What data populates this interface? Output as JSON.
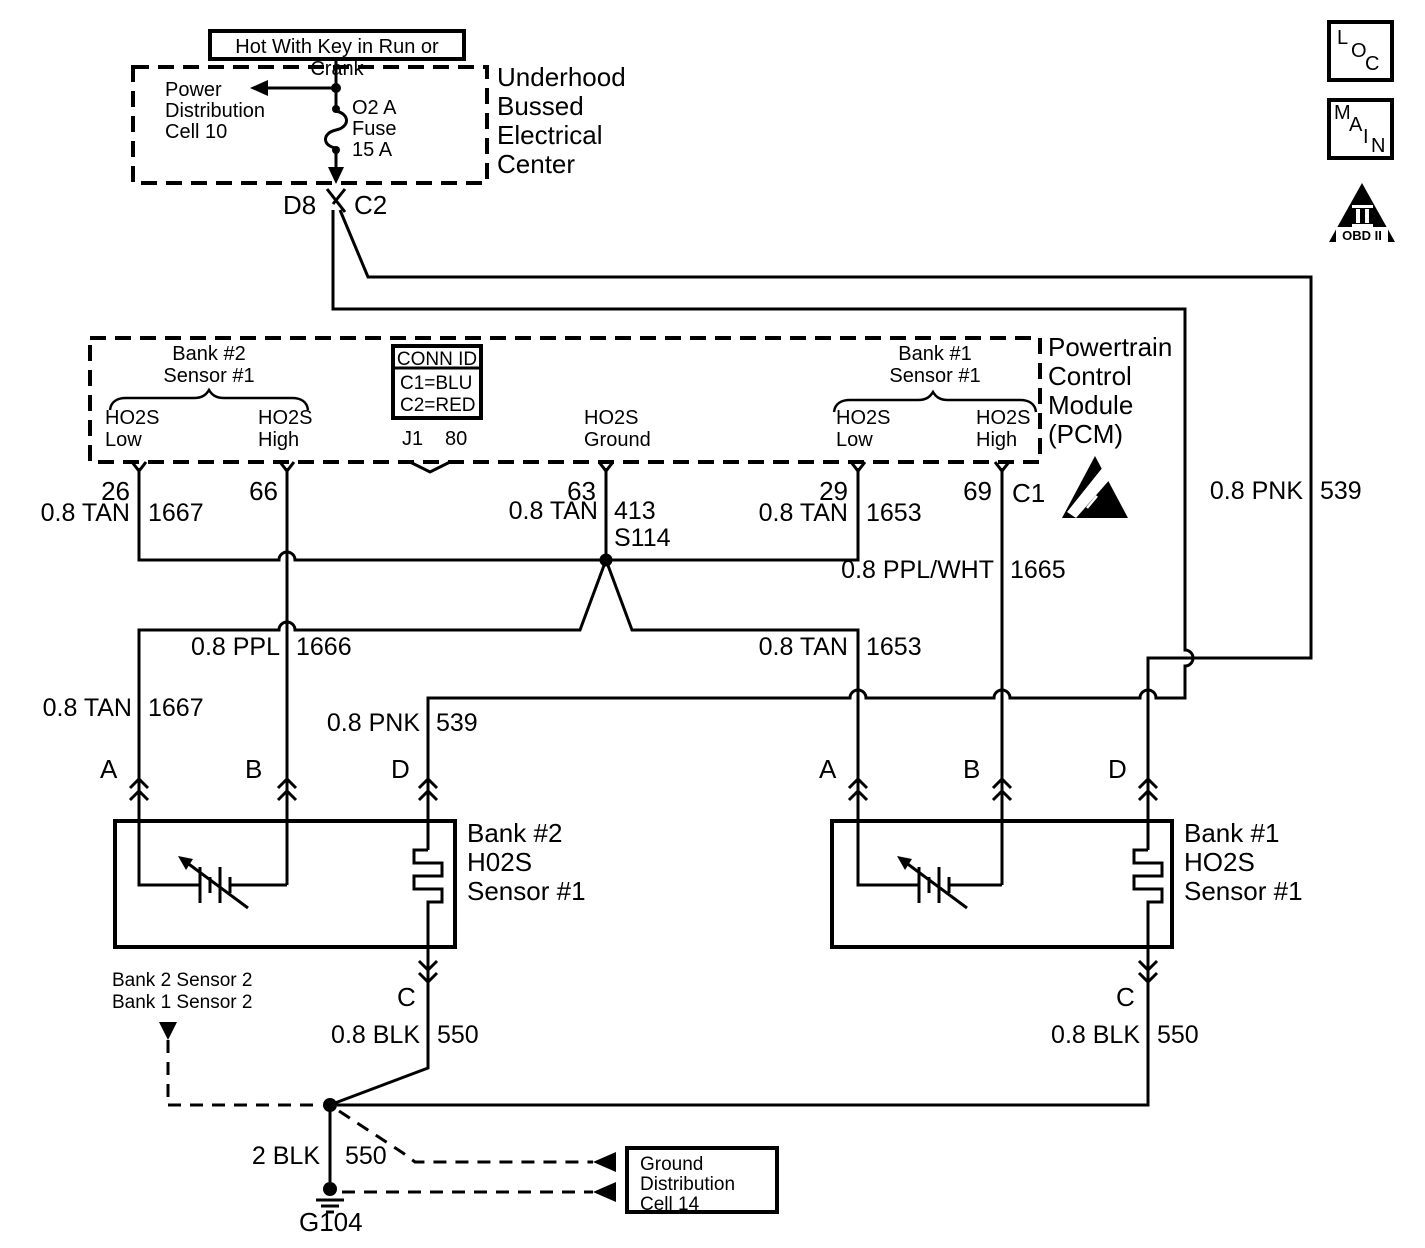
{
  "colors": {
    "line": "#000000",
    "background": "#ffffff"
  },
  "top": {
    "hot_label": "Hot With Key in Run or Crank",
    "power_lines": [
      "Power",
      "Distribution",
      "Cell 10"
    ],
    "fuse_lines": [
      "O2 A",
      "Fuse",
      "15 A"
    ],
    "ubec_lines": [
      "Underhood",
      "Bussed",
      "Electrical",
      "Center"
    ],
    "d8": "D8",
    "c2": "C2"
  },
  "legend": {
    "loc": [
      "L",
      "O",
      "C"
    ],
    "main": [
      "M",
      "A",
      "I",
      "N"
    ],
    "obd_label": "OBD II"
  },
  "pcm": {
    "name_lines": [
      "Powertrain",
      "Control",
      "Module",
      "(PCM)"
    ],
    "bank2_header": [
      "Bank #2",
      "Sensor #1"
    ],
    "bank1_header": [
      "Bank #1",
      "Sensor #1"
    ],
    "b2_low": [
      "HO2S",
      "Low"
    ],
    "b2_high": [
      "HO2S",
      "High"
    ],
    "ground": [
      "HO2S",
      "Ground"
    ],
    "b1_low": [
      "HO2S",
      "Low"
    ],
    "b1_high": [
      "HO2S",
      "High"
    ],
    "conn_id": {
      "title": "CONN ID",
      "row1": "C1=BLU",
      "row2": "C2=RED"
    },
    "j1": "J1",
    "j1_pins": "80",
    "pins": {
      "p26": "26",
      "p66": "66",
      "p63": "63",
      "p29": "29",
      "p69": "69",
      "c1": "C1"
    }
  },
  "wires": {
    "pnk_top": {
      "g": "0.8 PNK",
      "c": "539"
    },
    "tan_26": {
      "g": "0.8 TAN",
      "c": "1667"
    },
    "tan_63": {
      "g": "0.8 TAN",
      "c": "413"
    },
    "splice": "S114",
    "tan_29": {
      "g": "0.8 TAN",
      "c": "1653"
    },
    "ppl_wht": {
      "g": "0.8 PPL/WHT",
      "c": "1665"
    },
    "ppl_66": {
      "g": "0.8 PPL",
      "c": "1666"
    },
    "tan_branch": {
      "g": "0.8 TAN",
      "c": "1653"
    },
    "tan_a": {
      "g": "0.8 TAN",
      "c": "1667"
    },
    "pnk_d": {
      "g": "0.8 PNK",
      "c": "539"
    },
    "blk_b2": {
      "g": "0.8 BLK",
      "c": "550"
    },
    "blk_b1": {
      "g": "0.8 BLK",
      "c": "550"
    },
    "blk_main": {
      "g": "2 BLK",
      "c": "550"
    }
  },
  "sensors": {
    "bank2": {
      "label_lines": [
        "Bank #2",
        "H02S",
        "Sensor #1"
      ],
      "pins": {
        "a": "A",
        "b": "B",
        "d": "D",
        "c": "C"
      }
    },
    "bank1": {
      "label_lines": [
        "Bank #1",
        "HO2S",
        "Sensor #1"
      ],
      "pins": {
        "a": "A",
        "b": "B",
        "d": "D",
        "c": "C"
      }
    }
  },
  "ground": {
    "refs": [
      "Bank 2 Sensor 2",
      "Bank 1 Sensor 2"
    ],
    "g104": "G104",
    "box_lines": [
      "Ground",
      "Distribution",
      "Cell 14"
    ]
  }
}
